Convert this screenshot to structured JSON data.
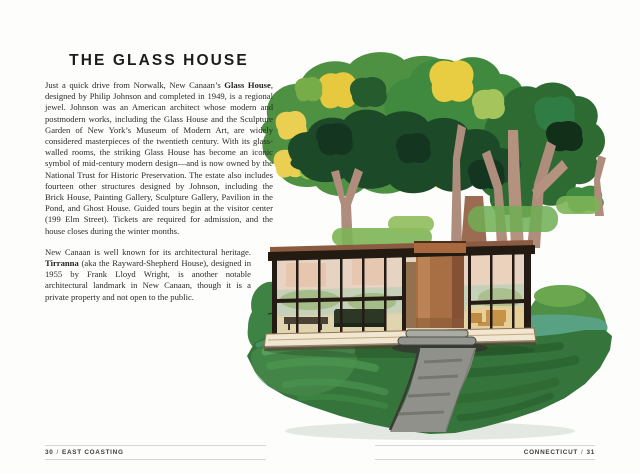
{
  "left_page": {
    "title": "THE GLASS HOUSE",
    "paragraphs": [
      {
        "segments": [
          {
            "t": "Just a quick drive from Norwalk, New Canaan’s "
          },
          {
            "t": "Glass House",
            "b": true
          },
          {
            "t": ", designed by Philip Johnson and completed in 1949, is a regional jewel. Johnson was an American architect whose modern and postmodern works, including the Glass House and the Sculpture Garden of New York’s Museum of Modern Art, are widely considered masterpieces of the twentieth century. With its glass-walled rooms, the striking Glass House has become an iconic symbol of mid-century modern design—and is now owned by the National Trust for Historic Preservation. The estate also includes fourteen other structures designed by Johnson, including the Brick House, Painting Gallery, Sculpture Gallery, Pavilion in the Pond, and Ghost House. Guided tours begin at the visitor center (199 Elm Street). Tickets are required for admission, and the house closes during the winter months."
          }
        ]
      },
      {
        "segments": [
          {
            "t": "New Canaan is well known for its architectural heritage. "
          },
          {
            "t": "Tirranna",
            "b": true
          },
          {
            "t": " (aka the Rayward-Shepherd House), designed in 1955 by Frank Lloyd Wright, is another notable architectural landmark in New Canaan, though it is a private property and not open to the public."
          }
        ]
      }
    ],
    "footer": {
      "page_number": "30",
      "separator": "/",
      "section": "EAST COASTING"
    }
  },
  "right_page": {
    "footer": {
      "section": "CONNECTICUT",
      "separator": "/",
      "page_number": "31"
    }
  },
  "palette": {
    "foliage_mid_green": "#4f9143",
    "foliage_dark_green": "#1c4a28",
    "foliage_yellow": "#e6c93f",
    "trunk_taupe": "#af8d7d",
    "house_frame_black": "#231a12",
    "chimney_brick": "#a86f45",
    "lawn_green": "#35743a",
    "path_gray": "#90918a",
    "teal_green": "#58a283"
  }
}
